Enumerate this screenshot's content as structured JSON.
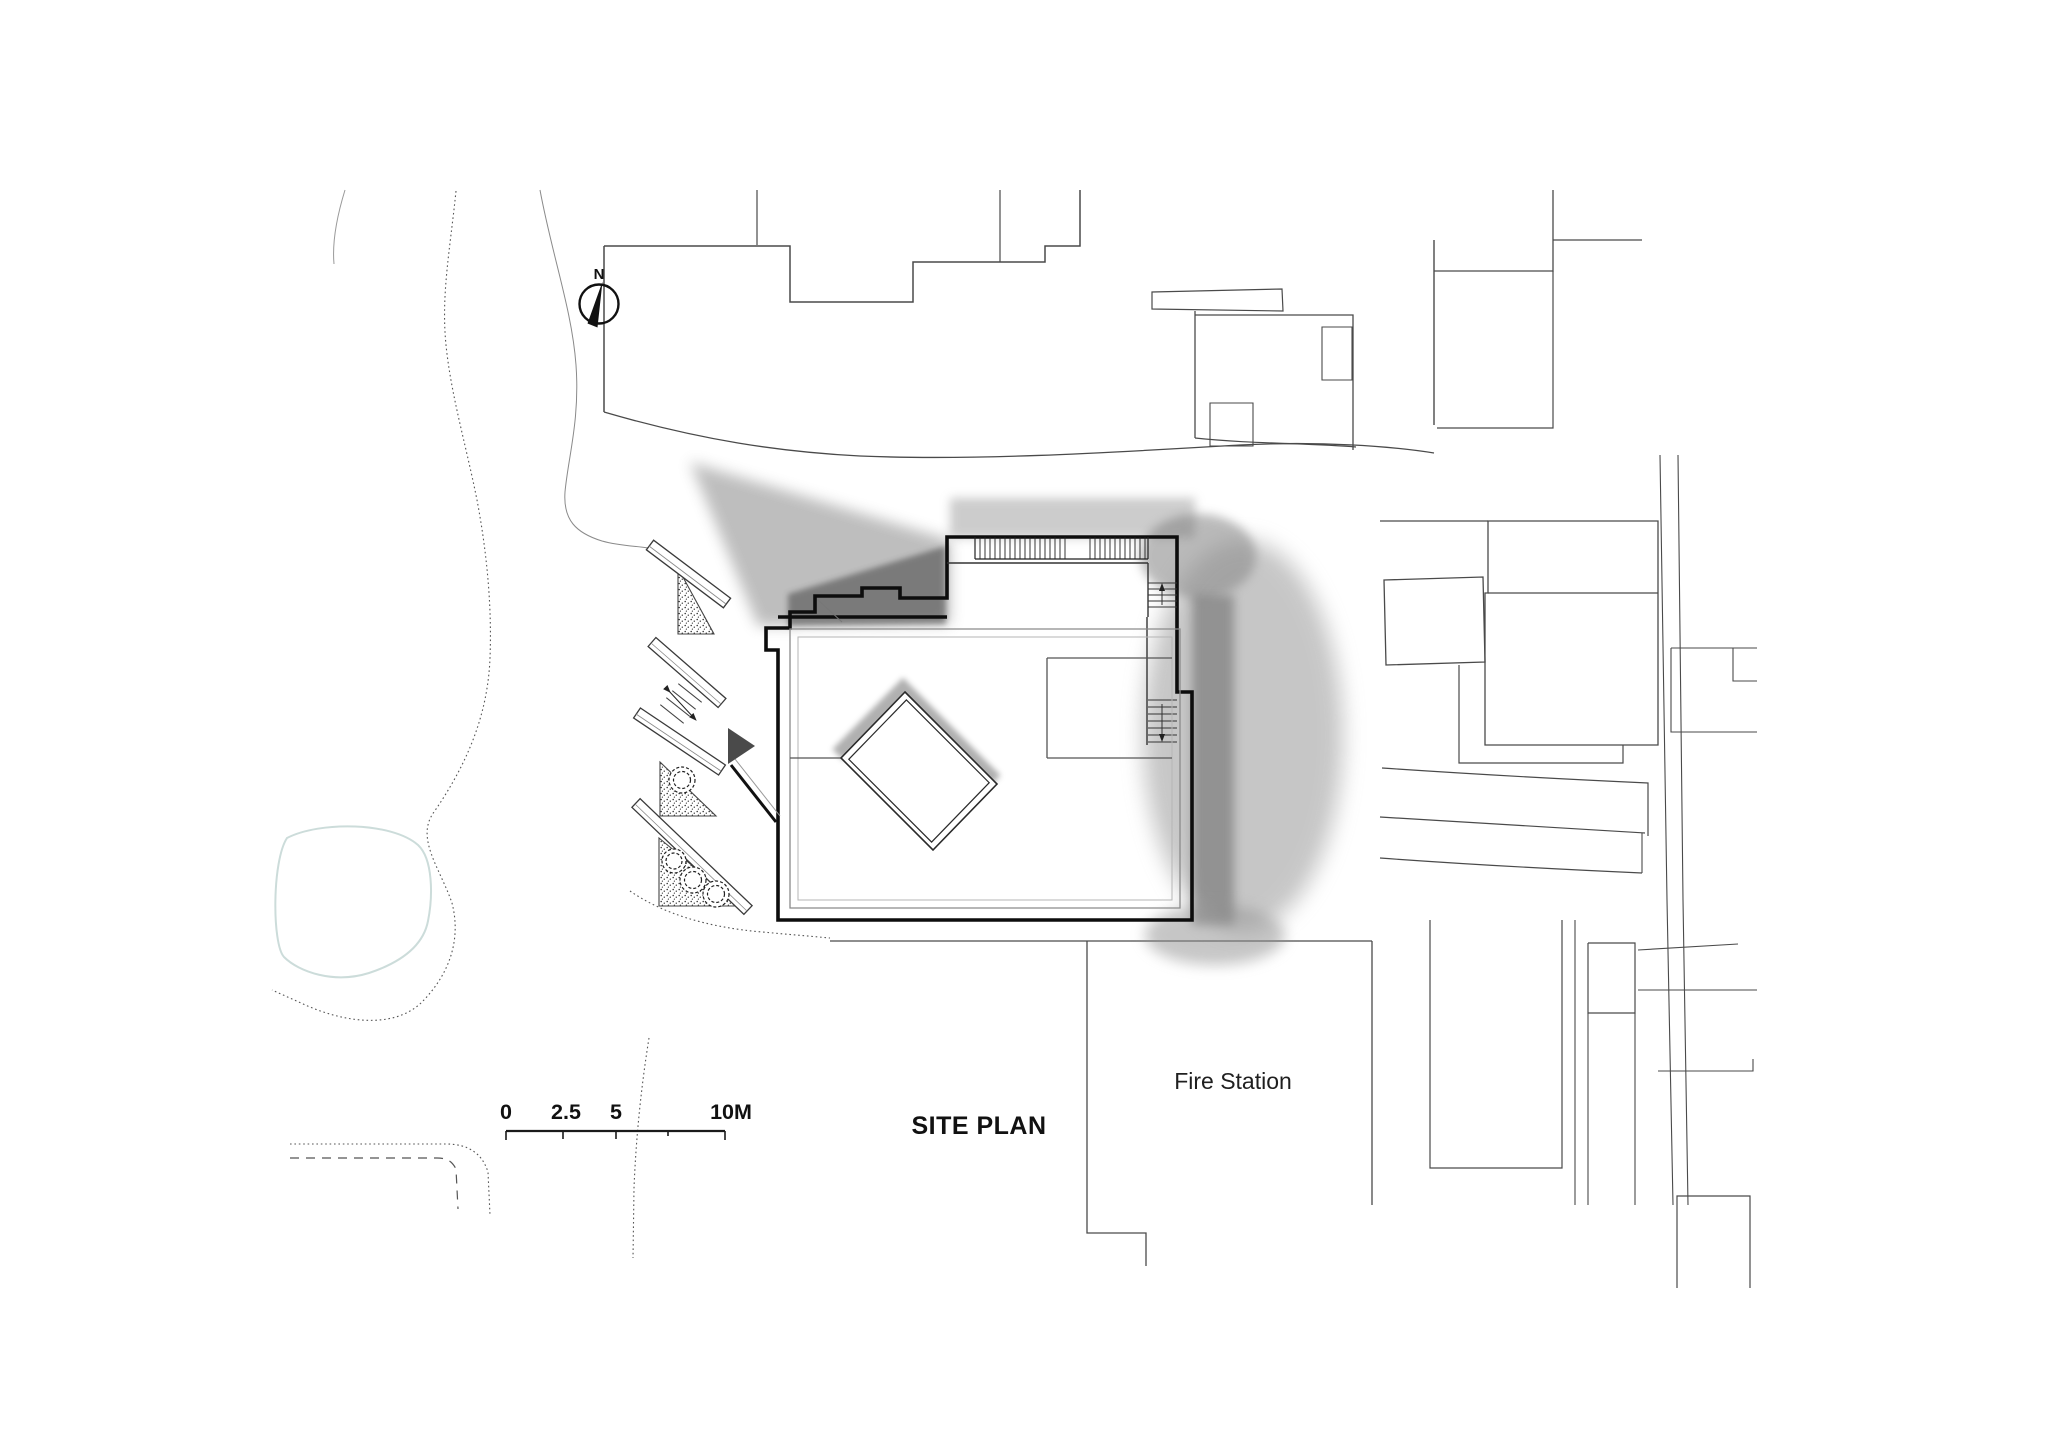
{
  "titles": {
    "site_plan": "SITE PLAN"
  },
  "labels": {
    "north": "N",
    "fire_station": "Fire Station"
  },
  "scale_bar": {
    "labels": [
      "0",
      "2.5",
      "5",
      "10M"
    ],
    "unit": "M"
  },
  "icons": {
    "north_arrow": "compass-north-arrow",
    "entrance_marker": "right-pointing-triangle"
  },
  "colors": {
    "background": "#ffffff",
    "heavy_line": "#0d0d0d",
    "context_line": "#4a4a4a",
    "shadow_gray": "#8e8e8e",
    "pond_outline": "#ccdcda",
    "entrance_marker": "#4a4a4a"
  }
}
